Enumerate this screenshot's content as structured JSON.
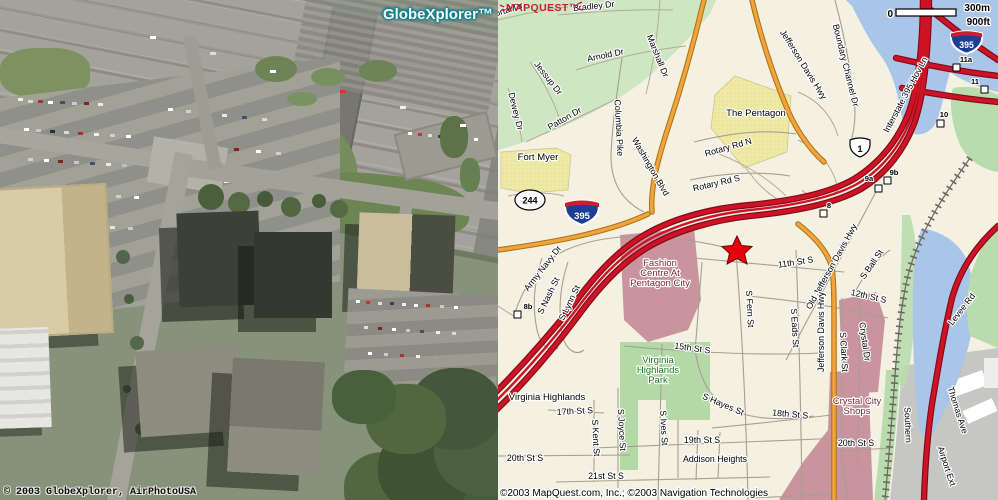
{
  "aerial": {
    "logo": "GlobeXplorer™",
    "copyright": "© 2003 GlobeXplorer, AirPhotoUSA"
  },
  "map": {
    "logo": "MAPQUEST™",
    "copyright": "©2003 MapQuest.com, Inc.; ©2003 Navigation Technologies",
    "scale": {
      "zero": "0",
      "metric": "300m",
      "imperial": "900ft"
    },
    "shield_i395": "395",
    "shield_us1": "1",
    "shield_va244": "244",
    "exits": [
      "11a",
      "11",
      "10",
      "9b",
      "9a",
      "8",
      "8b"
    ],
    "streets": [
      "Portal Dr",
      "Bradley Dr",
      "Arnold Dr",
      "Marshall Dr",
      "Jessup Dr",
      "Dewey Dr",
      "Patton Dr",
      "Columbia Pike",
      "Washington Blvd",
      "Jefferson Davis Hwy",
      "Boundary Channel Dr",
      "Interstate 395 Hov Ln",
      "Rotary Rd N",
      "Rotary Rd S",
      "Old Jefferson Davis Hwy",
      "Army Navy Dr",
      "S Nash St",
      "S Lynn St",
      "11th St S",
      "S Fern St",
      "S Eads St",
      "12th St S",
      "S Ball St",
      "Jefferson Davis Hwy",
      "S Clark St",
      "Crystal Dr",
      "Levee Rd",
      "15th St S",
      "S Hayes St",
      "18th St S",
      "19th St S",
      "S Ives St",
      "S Joyce St",
      "S Kent St",
      "17th St S",
      "20th St S",
      "21st St S",
      "20th St S",
      "Thomas Ave",
      "Airport Ext",
      "Southern",
      "Addison Heights"
    ],
    "places": [
      "The Pentagon",
      "Fort Myer",
      "Fashion",
      "Centre At",
      "Pentagon City",
      "Virginia",
      "Highlands",
      "Park",
      "Virginia Highlands",
      "Crystal City",
      "Shops"
    ],
    "colors": {
      "freeway_red": "#d01226",
      "highway_orange": "#f2a33c",
      "water_blue": "#a9c6e8",
      "park_green": "#cfe6c2",
      "poi_yellow": "#efe9a6",
      "mall_mauve": "#c9949e",
      "marker_red": "#e8000a",
      "mapquest_red": "#c32032",
      "globexplorer_teal": "#0e7f8f"
    }
  }
}
